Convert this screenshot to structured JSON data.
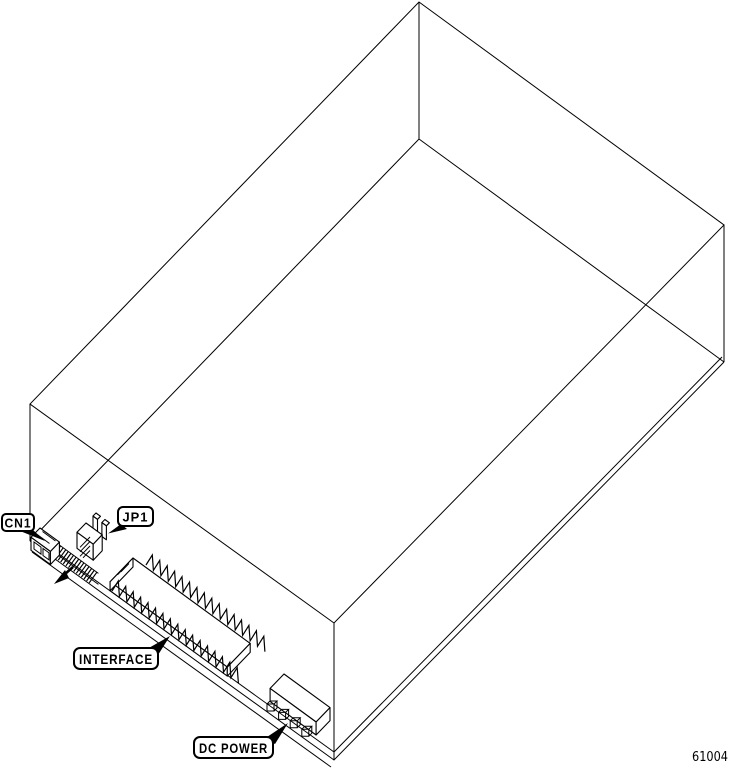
{
  "diagram": {
    "description": "Isometric wireframe line drawing of a disk drive showing rear PCB connectors",
    "part_number": "61004",
    "connector_labels": {
      "cn1": "CN1",
      "jp1": "JP1",
      "interface": "INTERFACE",
      "dc_power": "DC POWER"
    },
    "colors": {
      "line": "#000000",
      "background": "#ffffff"
    }
  }
}
